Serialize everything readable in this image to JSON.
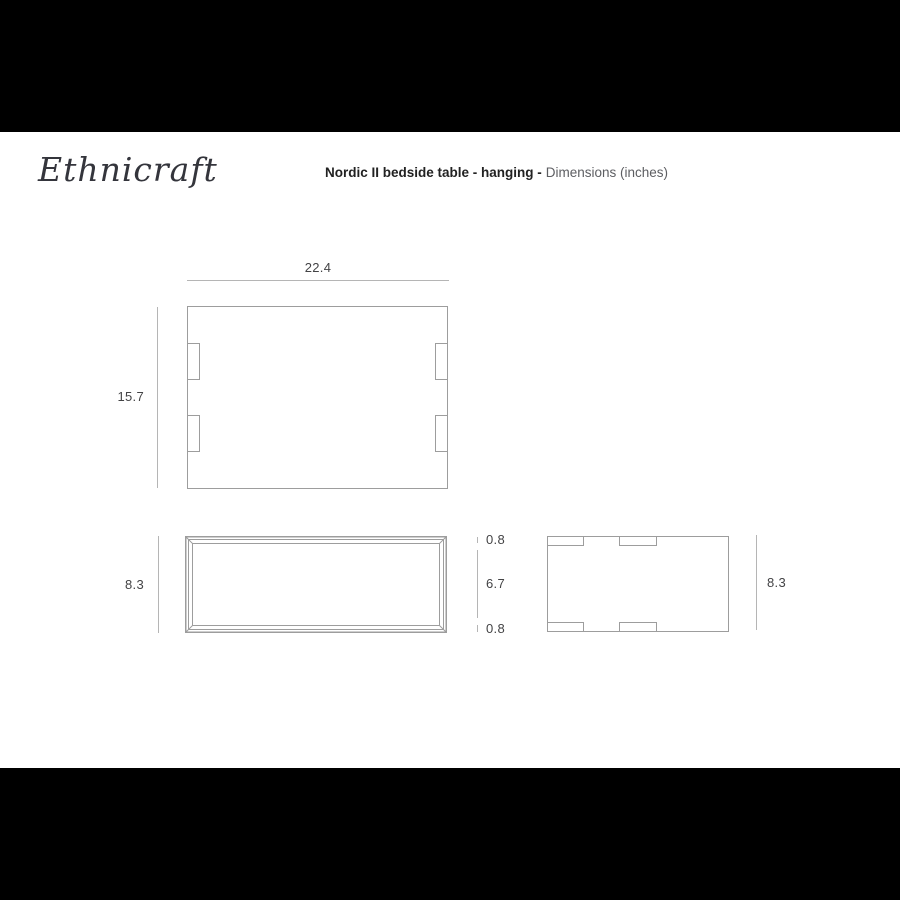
{
  "header": {
    "brand": "Ethnicraft",
    "product_bold": "Nordic II bedside table - hanging -",
    "subtitle": "Dimensions (inches)"
  },
  "top_view": {
    "width": "22.4",
    "depth": "15.7"
  },
  "front_view": {
    "height": "8.3",
    "top_panel": "0.8",
    "opening": "6.7",
    "bottom_panel": "0.8"
  },
  "side_view": {
    "height": "8.3"
  },
  "colors": {
    "outline": "#9d9d9d",
    "dimension_line": "#b5b5b5",
    "dimension_text": "#434345",
    "title_text": "#222222",
    "subtitle_text": "#5d5e62",
    "brand_text": "#34353c",
    "letterbox": "#000000",
    "canvas": "#ffffff"
  }
}
